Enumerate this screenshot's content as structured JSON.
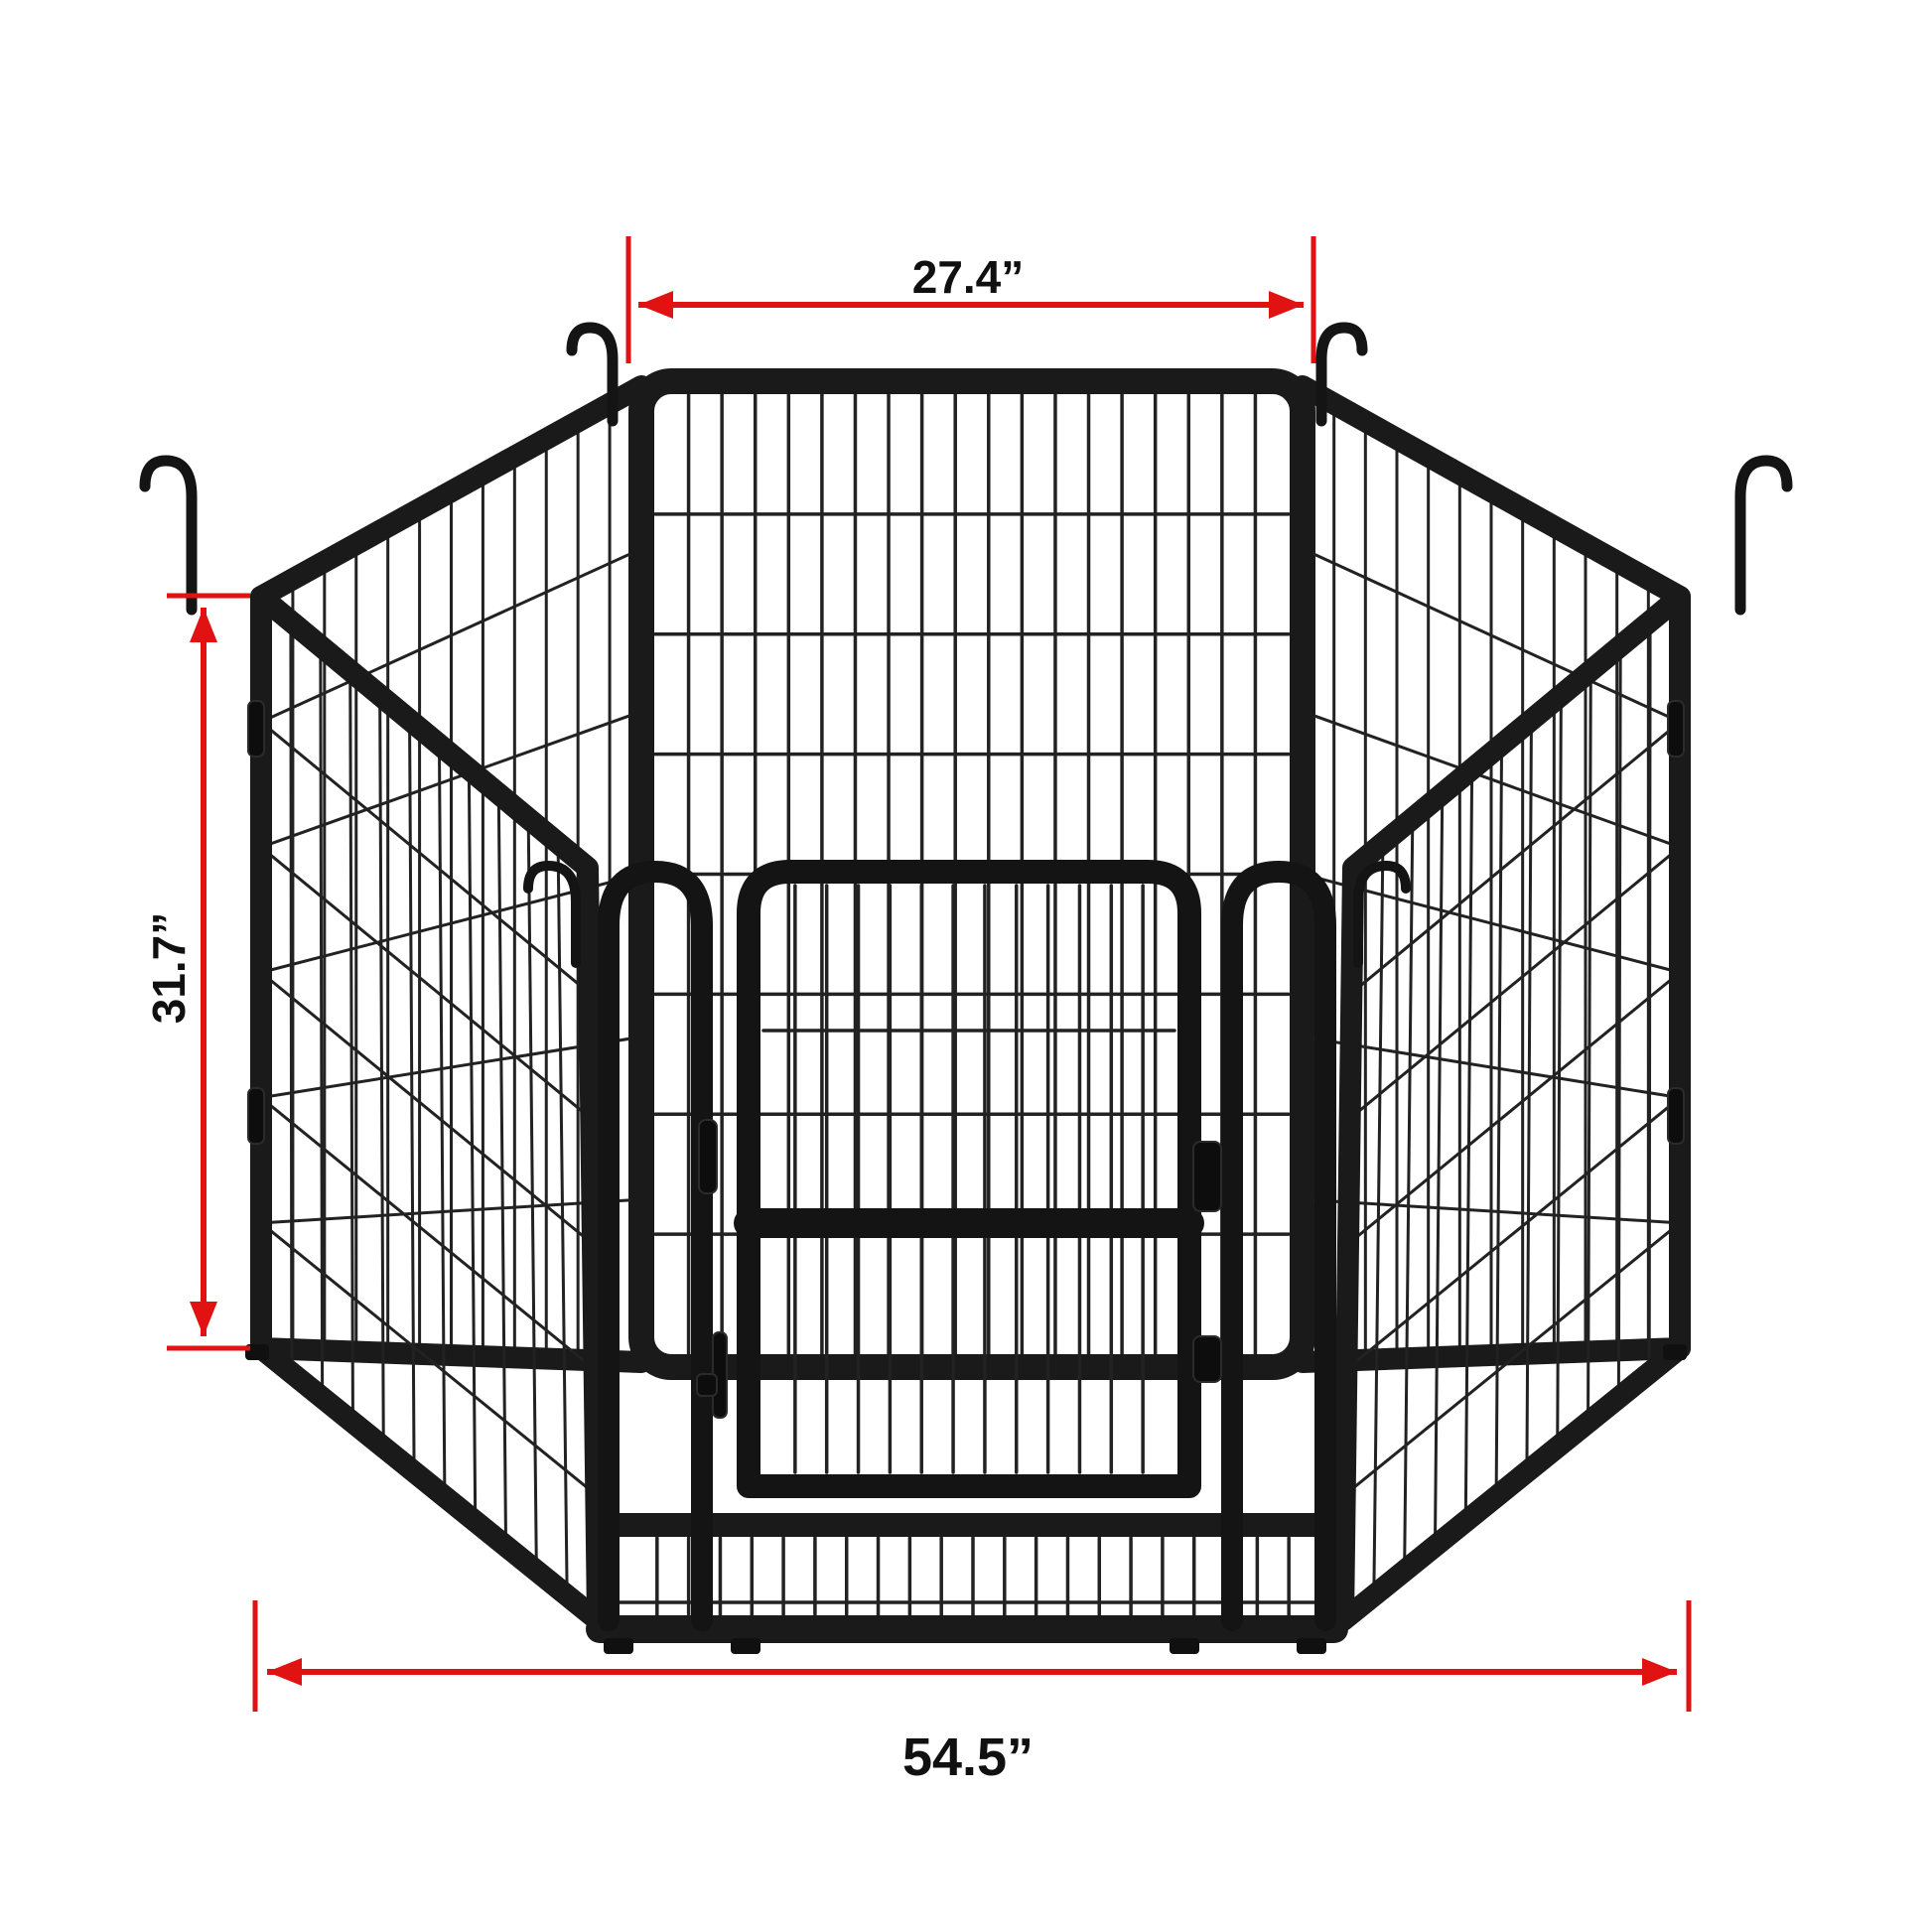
{
  "diagram": {
    "subject": "six-panel metal pet playpen with door, hexagonal setup",
    "annotation_color": "#e11212",
    "label_color": "#101010",
    "frame_color": "#1a1a1a",
    "background_color": "#ffffff",
    "dimensions": {
      "top_width": "27.4”",
      "panel_height": "31.7”",
      "total_width": "54.5”"
    }
  }
}
